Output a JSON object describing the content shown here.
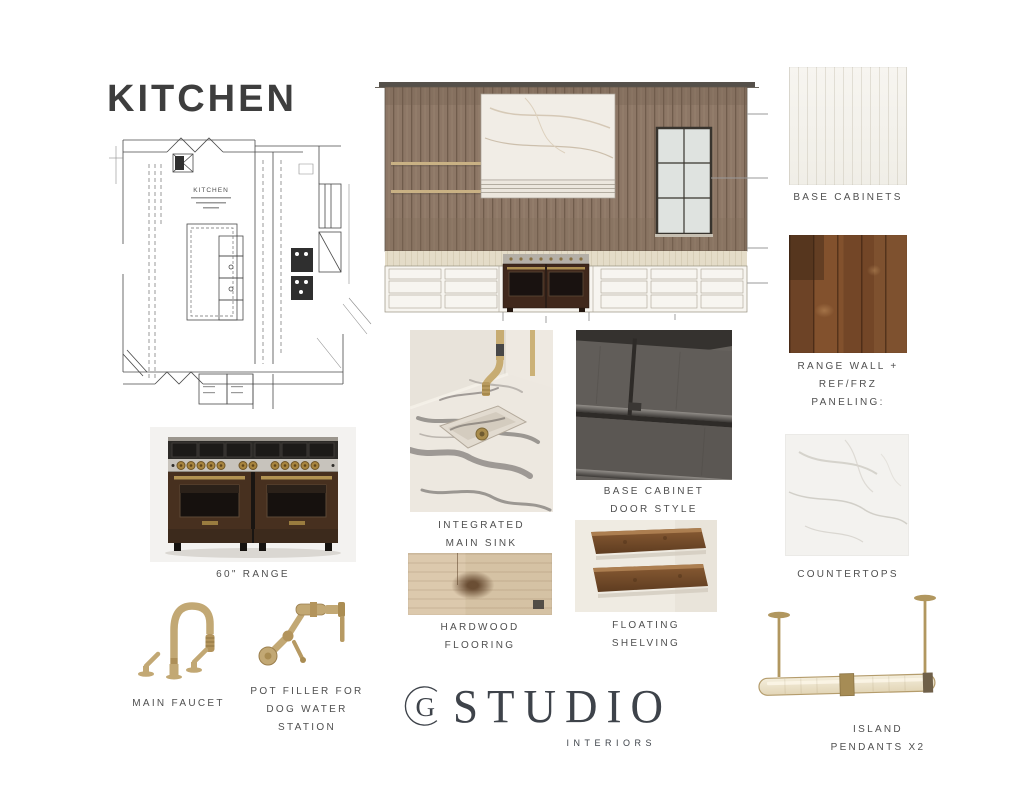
{
  "title": "KITCHEN",
  "floor_plan": {
    "label": "KITCHEN"
  },
  "swatches": {
    "base_cabinets": {
      "label": "BASE CABINETS"
    },
    "range_wall": {
      "label_lines": [
        "RANGE WALL +",
        "REF/FRZ",
        "PANELING:"
      ]
    },
    "countertops": {
      "label": "COUNTERTOPS"
    }
  },
  "items": {
    "integrated_sink": {
      "label_lines": [
        "INTEGRATED",
        "MAIN SINK"
      ]
    },
    "base_cabinet_door": {
      "label_lines": [
        "BASE CABINET",
        "DOOR STYLE"
      ]
    },
    "hardwood_flooring": {
      "label_lines": [
        "HARDWOOD",
        "FLOORING"
      ]
    },
    "floating_shelving": {
      "label_lines": [
        "FLOATING",
        "SHELVING"
      ]
    },
    "range": {
      "label": "60\" RANGE"
    },
    "main_faucet": {
      "label": "MAIN FAUCET"
    },
    "pot_filler": {
      "label_lines": [
        "POT FILLER FOR",
        "DOG WATER",
        "STATION"
      ]
    },
    "island_pendants": {
      "label_lines": [
        "ISLAND",
        "PENDANTS X2"
      ]
    }
  },
  "logo": {
    "monogram": "G",
    "name": "STUDIO",
    "subtitle": "INTERIORS"
  },
  "colors": {
    "background": "#ffffff",
    "label_gray": "#4f4f4f",
    "title_charcoal": "#3e3e3e",
    "brass": "#c2a874",
    "paneling_wood": "#8b7463",
    "range_wall_wood": "#7c4f30",
    "cabinet_door_gray": "#615d59",
    "logo_ink": "#3e434a"
  }
}
